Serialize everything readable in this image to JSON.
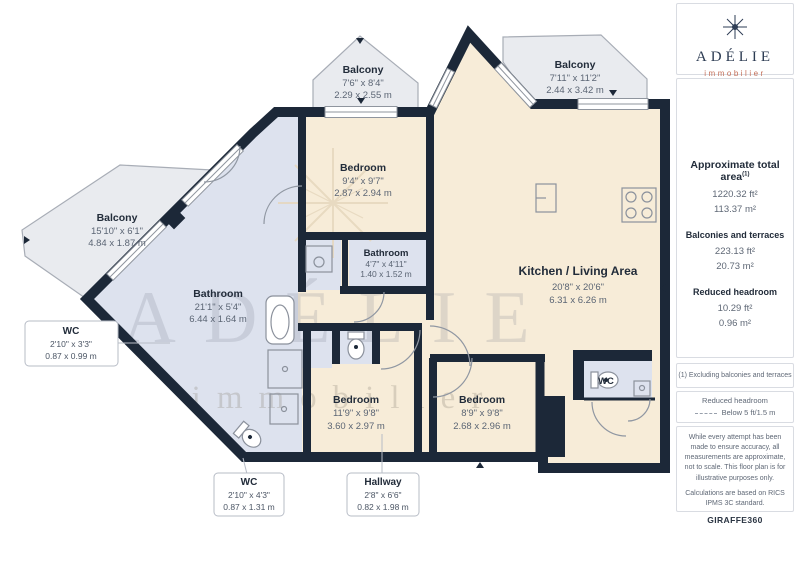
{
  "logo": {
    "name": "ADÉLIE",
    "tagline": "immobilier"
  },
  "sidebar": {
    "total_area": {
      "title": "Approximate total area",
      "marker": "(1)",
      "ft": "1220.32 ft²",
      "m": "113.37 m²"
    },
    "balconies": {
      "title": "Balconies and terraces",
      "ft": "223.13 ft²",
      "m": "20.73 m²"
    },
    "headroom": {
      "title": "Reduced headroom",
      "ft": "10.29 ft²",
      "m": "0.96 m²"
    },
    "footnote": "(1) Excluding balconies and terraces",
    "legend": {
      "title": "Reduced headroom",
      "item": "Below 5 ft/1.5 m"
    },
    "disclaimer1": "While every attempt has been made to ensure accuracy, all measurements are approximate, not to scale. This floor plan is for illustrative purposes only.",
    "disclaimer2": "Calculations are based on RICS IPMS 3C standard.",
    "brand": {
      "name": "GIRAFFE",
      "suffix": "360"
    }
  },
  "floorplan": {
    "watermark": {
      "line1": "ADÉLIE",
      "line2": "immobilier"
    },
    "rooms": {
      "balcony_left": {
        "name": "Balcony",
        "imperial": "15'10\" x 6'1\"",
        "metric": "4.84 x 1.87 m"
      },
      "balcony_top": {
        "name": "Balcony",
        "imperial": "7'6\" x 8'4\"",
        "metric": "2.29 x 2.55 m"
      },
      "balcony_right": {
        "name": "Balcony",
        "imperial": "7'11\" x 11'2\"",
        "metric": "2.44 x 3.42 m"
      },
      "bedroom_top": {
        "name": "Bedroom",
        "imperial": "9'4\" x 9'7\"",
        "metric": "2.87 x 2.94 m"
      },
      "bathroom_small": {
        "name": "Bathroom",
        "imperial": "4'7\" x 4'11\"",
        "metric": "1.40 x 1.52 m"
      },
      "bathroom_long": {
        "name": "Bathroom",
        "imperial": "21'1\" x 5'4\"",
        "metric": "6.44 x 1.64 m"
      },
      "kitchen_living": {
        "name": "Kitchen / Living Area",
        "imperial": "20'8\" x 20'6\"",
        "metric": "6.31 x 6.26 m"
      },
      "bedroom_left": {
        "name": "Bedroom",
        "imperial": "11'9\" x 9'8\"",
        "metric": "3.60 x 2.97 m"
      },
      "bedroom_right": {
        "name": "Bedroom",
        "imperial": "8'9\" x 9'8\"",
        "metric": "2.68 x 2.96 m"
      },
      "wc_room": {
        "name": "WC"
      }
    },
    "callouts": {
      "wc_left": {
        "name": "WC",
        "imperial": "2'10\" x 3'3\"",
        "metric": "0.87 x 0.99 m"
      },
      "wc_bottom": {
        "name": "WC",
        "imperial": "2'10\" x 4'3\"",
        "metric": "0.87 x 1.31 m"
      },
      "hallway": {
        "name": "Hallway",
        "imperial": "2'8\" x 6'6\"",
        "metric": "0.82 x 1.98 m"
      }
    },
    "colors": {
      "wall": "#1c2838",
      "room": "#f7ecd8",
      "wet_room": "#dde2ee",
      "balcony": "#e9ebef"
    }
  }
}
